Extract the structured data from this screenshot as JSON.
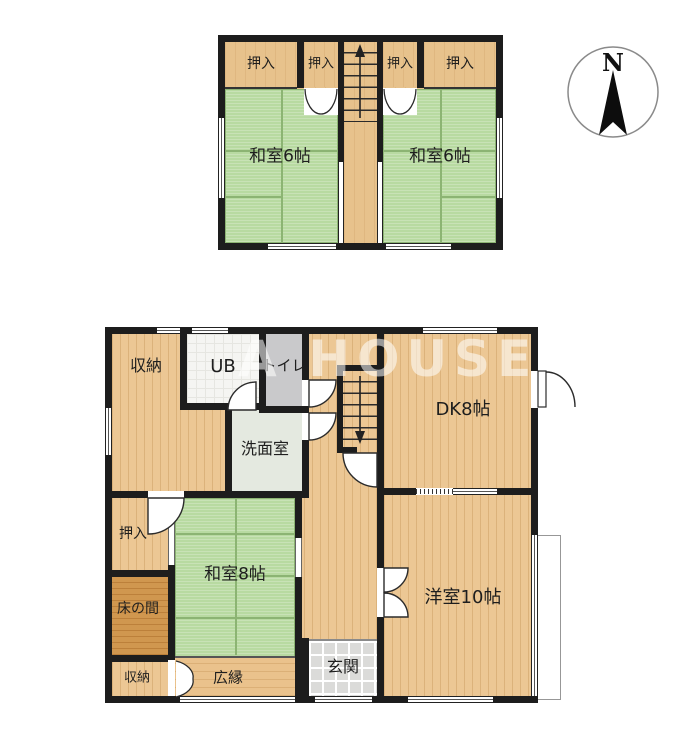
{
  "watermark": "A HOUSE",
  "compass": {
    "north_label": "N"
  },
  "floor2": {
    "oshiire1": "押入",
    "oshiire2": "押入",
    "oshiire3": "押入",
    "oshiire4": "押入",
    "washitsu_left": "和室6帖",
    "washitsu_right": "和室6帖"
  },
  "floor1": {
    "shuno_top": "収納",
    "ub": "UB",
    "toilet": "トイレ",
    "senmenshitsu": "洗面室",
    "oshiire": "押入",
    "tokonoma": "床の間",
    "shuno_bottom": "収納",
    "washitsu8": "和室8帖",
    "hiroen": "広縁",
    "genkan": "玄関",
    "dk": "DK8帖",
    "yoshitsu": "洋室10帖"
  },
  "colors": {
    "wall": "#1d1d1d",
    "wood_floor": "#ecc794",
    "tatami": "#b8daa1",
    "tokonoma": "#d0974f",
    "entry_tile": "#dbdbd9",
    "toilet": "#c9c9cb",
    "unit_bath": "#f5f5f2",
    "washroom": "#e4e9e0"
  }
}
